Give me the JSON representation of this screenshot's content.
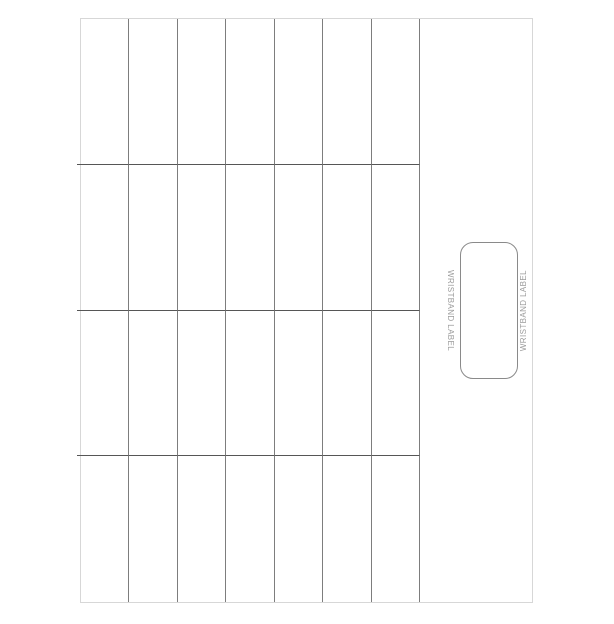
{
  "sheet": {
    "grid": {
      "columns": 7,
      "rows": 4,
      "label_count": 28
    },
    "wristband": {
      "label_left": "WRISTBAND LABEL",
      "label_right": "WRISTBAND LABEL"
    },
    "colors": {
      "background": "#ffffff",
      "page_border": "#d7d7d7",
      "grid_vertical_line": "#7d7d7d",
      "grid_horizontal_line": "#565656",
      "wristband_border": "#8a8a8a",
      "wristband_text": "#9b9b9b"
    }
  }
}
